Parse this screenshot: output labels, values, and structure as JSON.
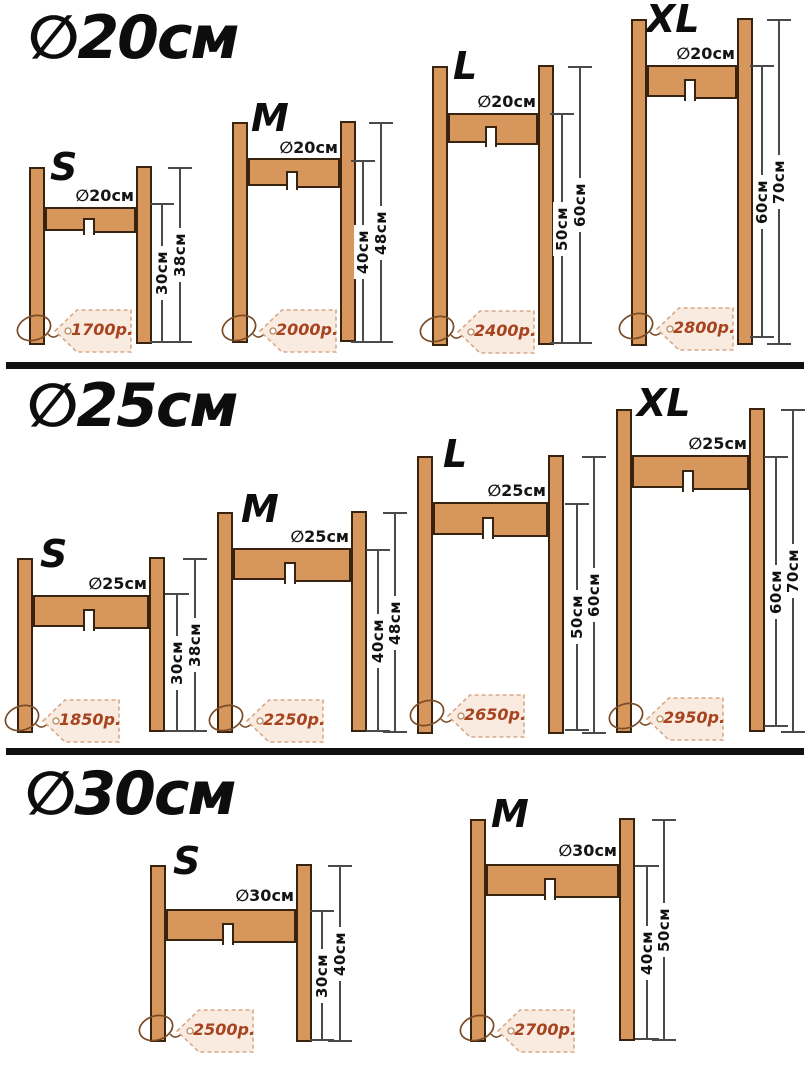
{
  "sections": [
    {
      "title": "∅20см",
      "stands": [
        {
          "size": "S",
          "diameter_label": "∅20см",
          "height_to_shelf": "30см",
          "total_height": "38см",
          "price": "1700р."
        },
        {
          "size": "M",
          "diameter_label": "∅20см",
          "height_to_shelf": "40см",
          "total_height": "48см",
          "price": "2000р."
        },
        {
          "size": "L",
          "diameter_label": "∅20см",
          "height_to_shelf": "50см",
          "total_height": "60см",
          "price": "2400р."
        },
        {
          "size": "XL",
          "diameter_label": "∅20см",
          "height_to_shelf": "60см",
          "total_height": "70см",
          "price": "2800р."
        }
      ]
    },
    {
      "title": "∅25см",
      "stands": [
        {
          "size": "S",
          "diameter_label": "∅25см",
          "height_to_shelf": "30см",
          "total_height": "38см",
          "price": "1850р."
        },
        {
          "size": "M",
          "diameter_label": "∅25см",
          "height_to_shelf": "40см",
          "total_height": "48см",
          "price": "2250р."
        },
        {
          "size": "L",
          "diameter_label": "∅25см",
          "height_to_shelf": "50см",
          "total_height": "60см",
          "price": "2650р."
        },
        {
          "size": "XL",
          "diameter_label": "∅25см",
          "height_to_shelf": "60см",
          "total_height": "70см",
          "price": "2950р."
        }
      ]
    },
    {
      "title": "∅30см",
      "stands": [
        {
          "size": "S",
          "diameter_label": "∅30см",
          "height_to_shelf": "30см",
          "total_height": "40см",
          "price": "2500р."
        },
        {
          "size": "M",
          "diameter_label": "∅30см",
          "height_to_shelf": "40см",
          "total_height": "50см",
          "price": "2700р."
        }
      ]
    }
  ],
  "colors": {
    "wood": "#d7975c",
    "wood_outline": "#38230e",
    "price_text": "#a8431f",
    "tag_fill": "#f9ebe0",
    "tag_border": "#d7a987",
    "dimension_line": "#4a4a4a",
    "text": "#0d0d0d",
    "string": "#7a4b26",
    "divider": "#111111"
  }
}
